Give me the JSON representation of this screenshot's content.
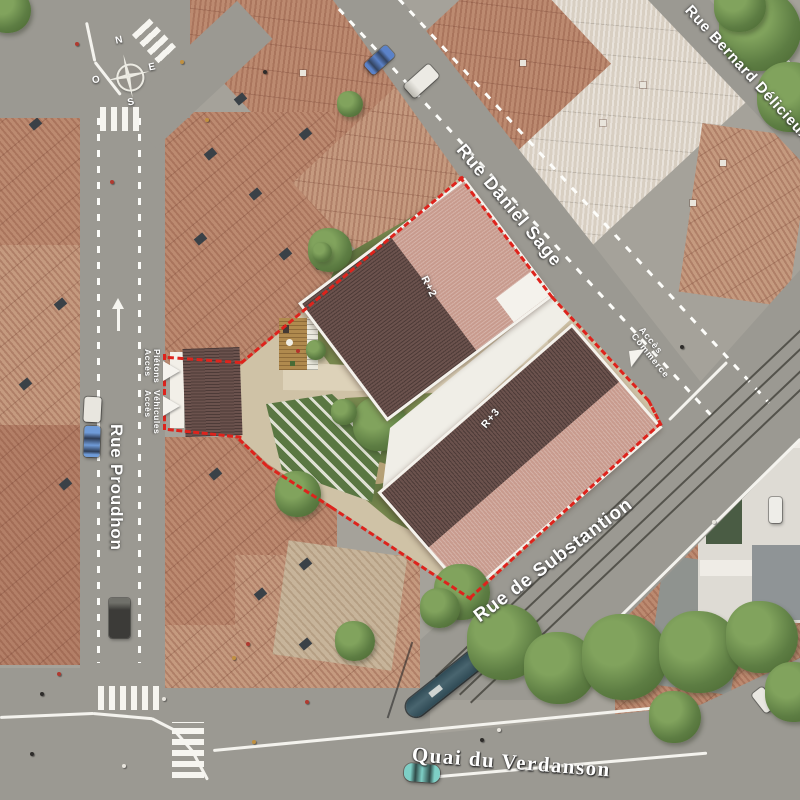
{
  "streets": {
    "bernard_delicieux": "Rue Bernard Délicieux",
    "daniel_sage": "Rue Daniel Sage",
    "proudhon": "Rue Proudhon",
    "substantion": "Rue de Substantion",
    "verdanson": "Quai du Verdanson"
  },
  "buildings": {
    "r2": "R+2",
    "r3": "R+3"
  },
  "access": {
    "acces": "Accès",
    "pietons": "Piétons",
    "vehicules": "Véhicules",
    "commerce": "Commerce"
  },
  "compass": {
    "n": "N",
    "e": "E",
    "s": "S",
    "o": "O"
  },
  "colors": {
    "site_boundary": "#de231c",
    "new_roof_dark": "#6b524d",
    "new_roof_light": "#c89b8e",
    "existing_roof": "#bc8a70",
    "street": "#9b9992",
    "garden": "#79894f",
    "path": "#ddd2b9",
    "label_text": "#ffffff"
  }
}
